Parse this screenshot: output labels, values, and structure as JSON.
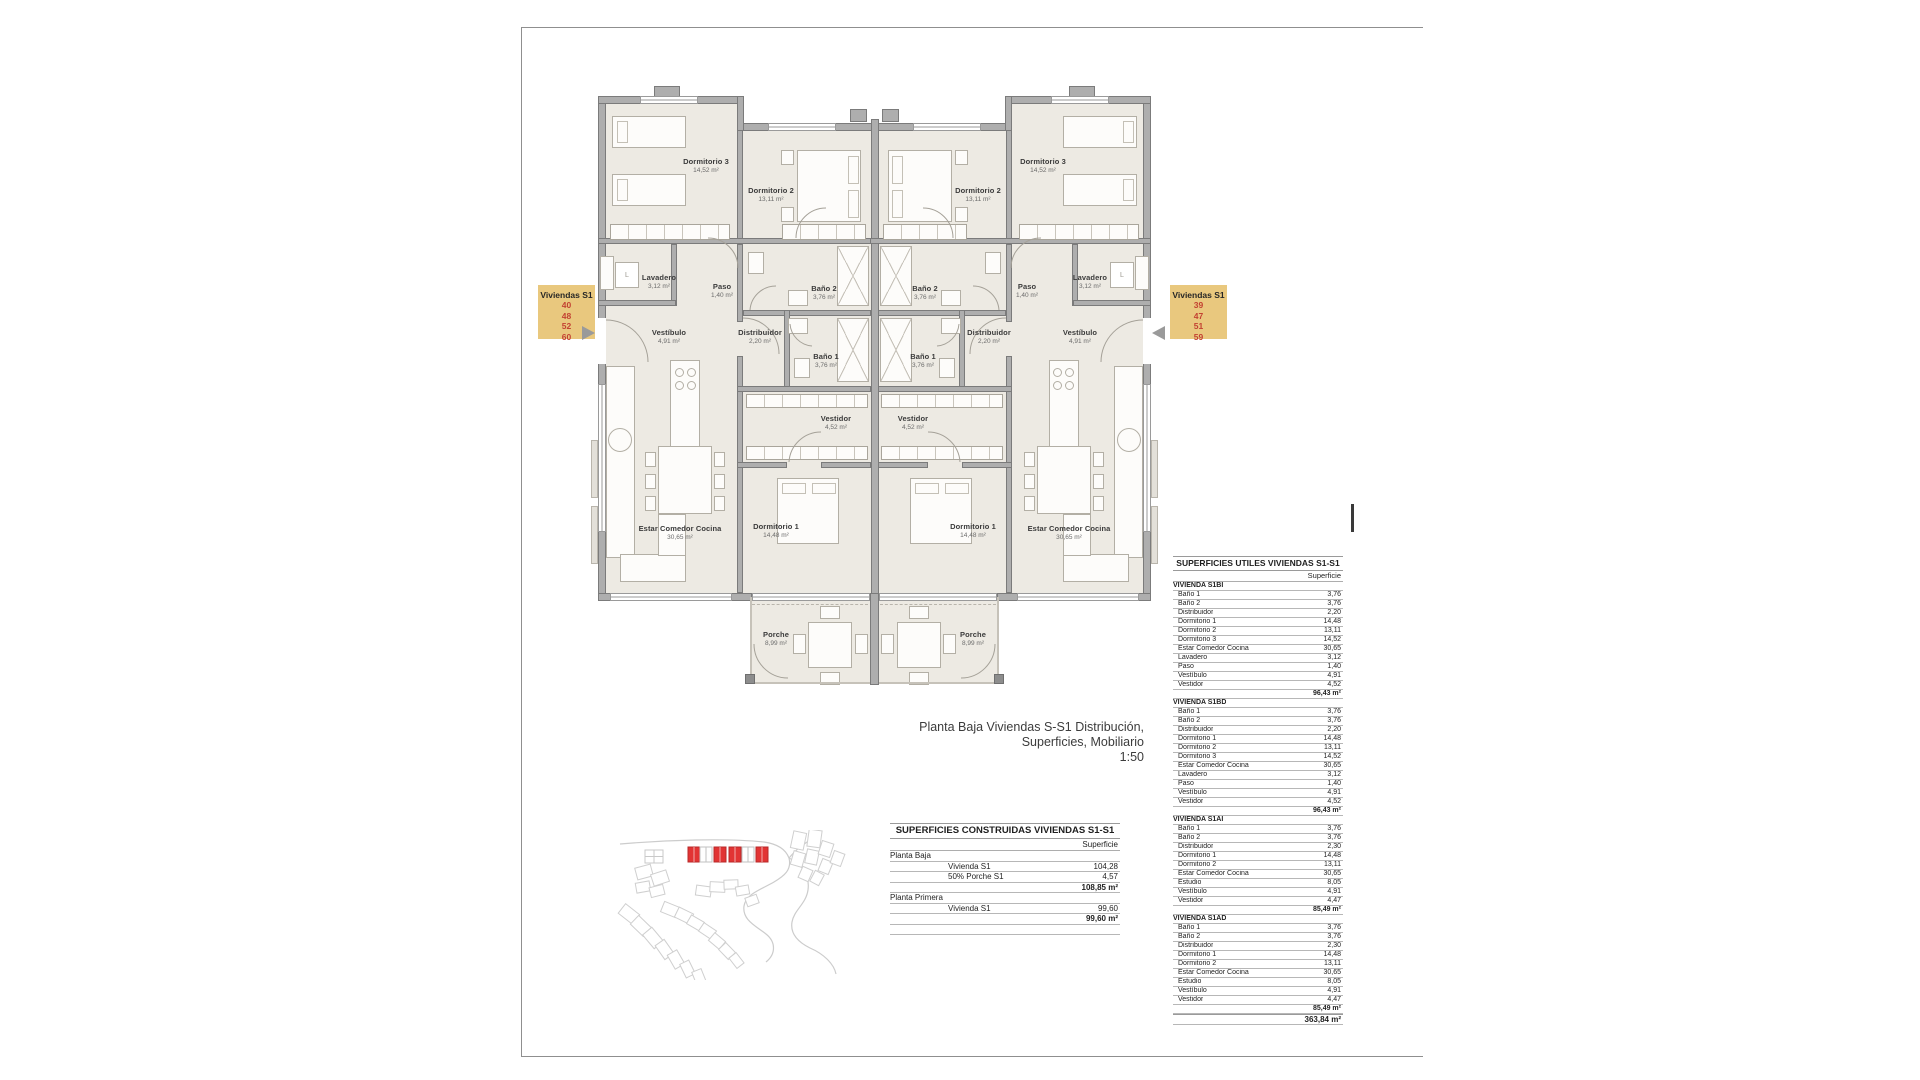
{
  "sheet": {
    "caption_line1": "Planta Baja Viviendas S-S1 Distribución, Superficies, Mobiliario",
    "caption_line2": "1:50"
  },
  "labels": {
    "left": {
      "title": "Viviendas S1",
      "numbers": [
        "40",
        "48",
        "52",
        "60"
      ]
    },
    "right": {
      "title": "Viviendas S1",
      "numbers": [
        "39",
        "47",
        "51",
        "59"
      ]
    }
  },
  "plan": {
    "appliance_letter": "L",
    "rooms": [
      {
        "name": "Dormitorio 3",
        "area": "14,52 m²"
      },
      {
        "name": "Dormitorio 2",
        "area": "13,11 m²"
      },
      {
        "name": "Lavadero",
        "area": "3,12 m²"
      },
      {
        "name": "Paso",
        "area": "1,40 m²"
      },
      {
        "name": "Baño 2",
        "area": "3,76 m²"
      },
      {
        "name": "Baño 1",
        "area": "3,76 m²"
      },
      {
        "name": "Distribuidor",
        "area": "2,20 m²"
      },
      {
        "name": "Vestíbulo",
        "area": "4,91 m²"
      },
      {
        "name": "Vestidor",
        "area": "4,52 m²"
      },
      {
        "name": "Dormitorio 1",
        "area": "14,48 m²"
      },
      {
        "name": "Estar Comedor Cocina",
        "area": "30,65 m²"
      },
      {
        "name": "Porche",
        "area": "8,99 m²"
      }
    ]
  },
  "construidas_table": {
    "title": "SUPERFICIES CONSTRUIDAS VIVIENDAS S1-S1",
    "col_header": "Superficie",
    "groups": [
      {
        "label": "Planta Baja",
        "rows": [
          [
            "Vivienda S1",
            "104,28"
          ],
          [
            "50% Porche S1",
            "4,57"
          ]
        ],
        "total": "108,85 m²"
      },
      {
        "label": "Planta Primera",
        "rows": [
          [
            "Vivienda S1",
            "99,60"
          ]
        ],
        "total": "99,60 m²"
      }
    ]
  },
  "utiles_table": {
    "title": "SUPERFICIES UTILES VIVIENDAS S1-S1",
    "col_header": "Superficie",
    "sections": [
      {
        "name": "VIVIENDA S1BI",
        "rows": [
          [
            "Baño 1",
            "3,76"
          ],
          [
            "Baño 2",
            "3,76"
          ],
          [
            "Distribuidor",
            "2,20"
          ],
          [
            "Dormitorio 1",
            "14,48"
          ],
          [
            "Dormitorio 2",
            "13,11"
          ],
          [
            "Dormitorio 3",
            "14,52"
          ],
          [
            "Estar Comedor Cocina",
            "30,65"
          ],
          [
            "Lavadero",
            "3,12"
          ],
          [
            "Paso",
            "1,40"
          ],
          [
            "Vestíbulo",
            "4,91"
          ],
          [
            "Vestidor",
            "4,52"
          ]
        ],
        "total": "96,43 m²"
      },
      {
        "name": "VIVIENDA S1BD",
        "rows": [
          [
            "Baño 1",
            "3,76"
          ],
          [
            "Baño 2",
            "3,76"
          ],
          [
            "Distribuidor",
            "2,20"
          ],
          [
            "Dormitorio 1",
            "14,48"
          ],
          [
            "Dormitorio 2",
            "13,11"
          ],
          [
            "Dormitorio 3",
            "14,52"
          ],
          [
            "Estar Comedor Cocina",
            "30,65"
          ],
          [
            "Lavadero",
            "3,12"
          ],
          [
            "Paso",
            "1,40"
          ],
          [
            "Vestíbulo",
            "4,91"
          ],
          [
            "Vestidor",
            "4,52"
          ]
        ],
        "total": "96,43 m²"
      },
      {
        "name": "VIVIENDA S1AI",
        "rows": [
          [
            "Baño 1",
            "3,76"
          ],
          [
            "Baño 2",
            "3,76"
          ],
          [
            "Distribuidor",
            "2,30"
          ],
          [
            "Dormitorio 1",
            "14,48"
          ],
          [
            "Dormitorio 2",
            "13,11"
          ],
          [
            "Estar Comedor Cocina",
            "30,65"
          ],
          [
            "Estudio",
            "8,05"
          ],
          [
            "Vestíbulo",
            "4,91"
          ],
          [
            "Vestidor",
            "4,47"
          ]
        ],
        "total": "85,49 m²"
      },
      {
        "name": "VIVIENDA S1AD",
        "rows": [
          [
            "Baño 1",
            "3,76"
          ],
          [
            "Baño 2",
            "3,76"
          ],
          [
            "Distribuidor",
            "2,30"
          ],
          [
            "Dormitorio 1",
            "14,48"
          ],
          [
            "Dormitorio 2",
            "13,11"
          ],
          [
            "Estar Comedor Cocina",
            "30,65"
          ],
          [
            "Estudio",
            "8,05"
          ],
          [
            "Vestíbulo",
            "4,91"
          ],
          [
            "Vestidor",
            "4,47"
          ]
        ],
        "total": "85,49 m²"
      }
    ],
    "grand_total": "363,84 m²"
  },
  "site_plan": {
    "highlight_color": "#e23434"
  }
}
